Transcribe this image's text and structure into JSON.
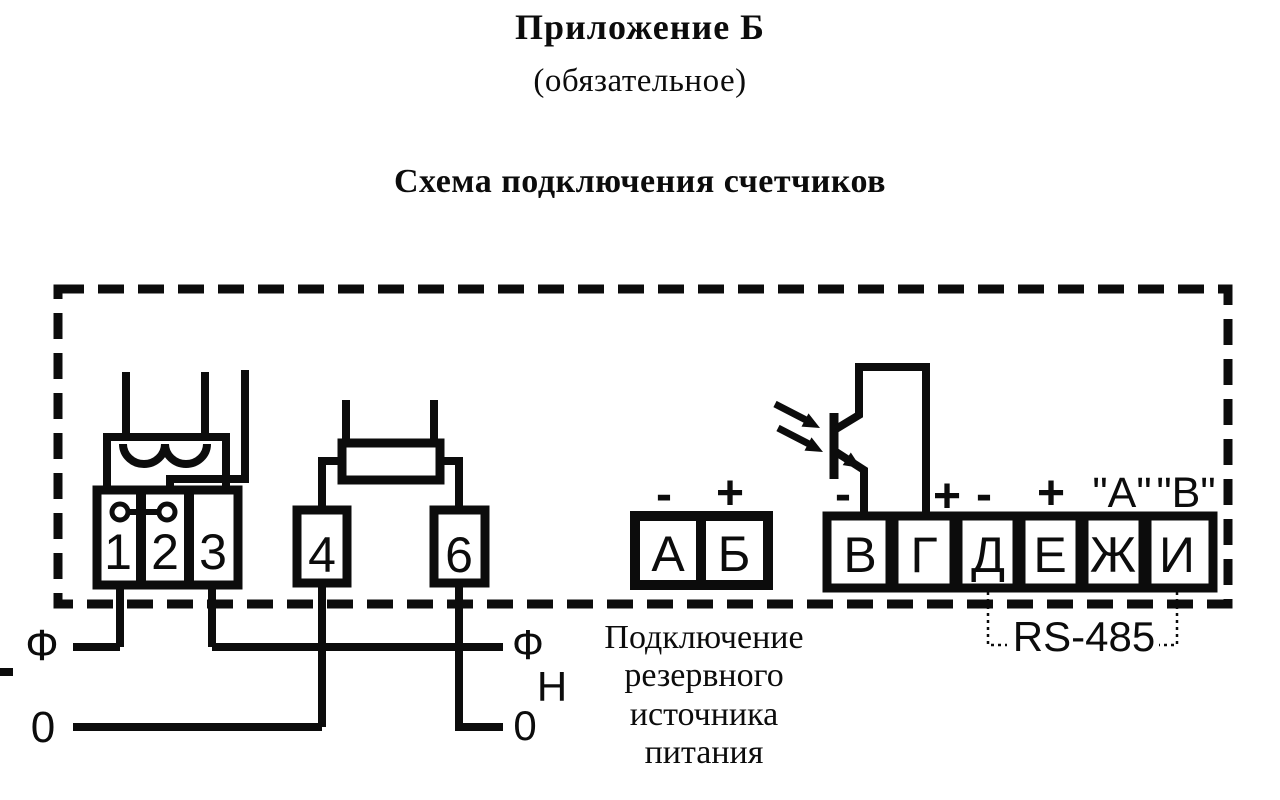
{
  "colors": {
    "ink": "#0c0c0c",
    "paper": "#ffffff"
  },
  "header": {
    "appendix": "Приложение Б",
    "mandatory": "(обязательное)",
    "title": "Схема подключения счетчиков"
  },
  "meter": {
    "current_terminals": [
      "1",
      "2",
      "3"
    ],
    "voltage_terminals": [
      "4",
      "6"
    ],
    "backup_terminals": [
      "А",
      "Б"
    ],
    "backup_polarity": [
      "-",
      "+"
    ],
    "interface_terminals": [
      "В",
      "Г",
      "Д",
      "Е",
      "Ж",
      "И"
    ],
    "interface_polarity": [
      "-",
      "+",
      "-",
      "+"
    ],
    "interface_line_labels": [
      "\"A\"",
      "\"B\""
    ],
    "bus_label": "RS-485"
  },
  "wires": {
    "phase_left": "Ф",
    "neutral_left": "0",
    "phase_right": "Ф",
    "load_right": "Н",
    "neutral_right": "0"
  },
  "caption": {
    "lines": [
      "Подключение",
      "резервного",
      "источника",
      "питания"
    ]
  }
}
